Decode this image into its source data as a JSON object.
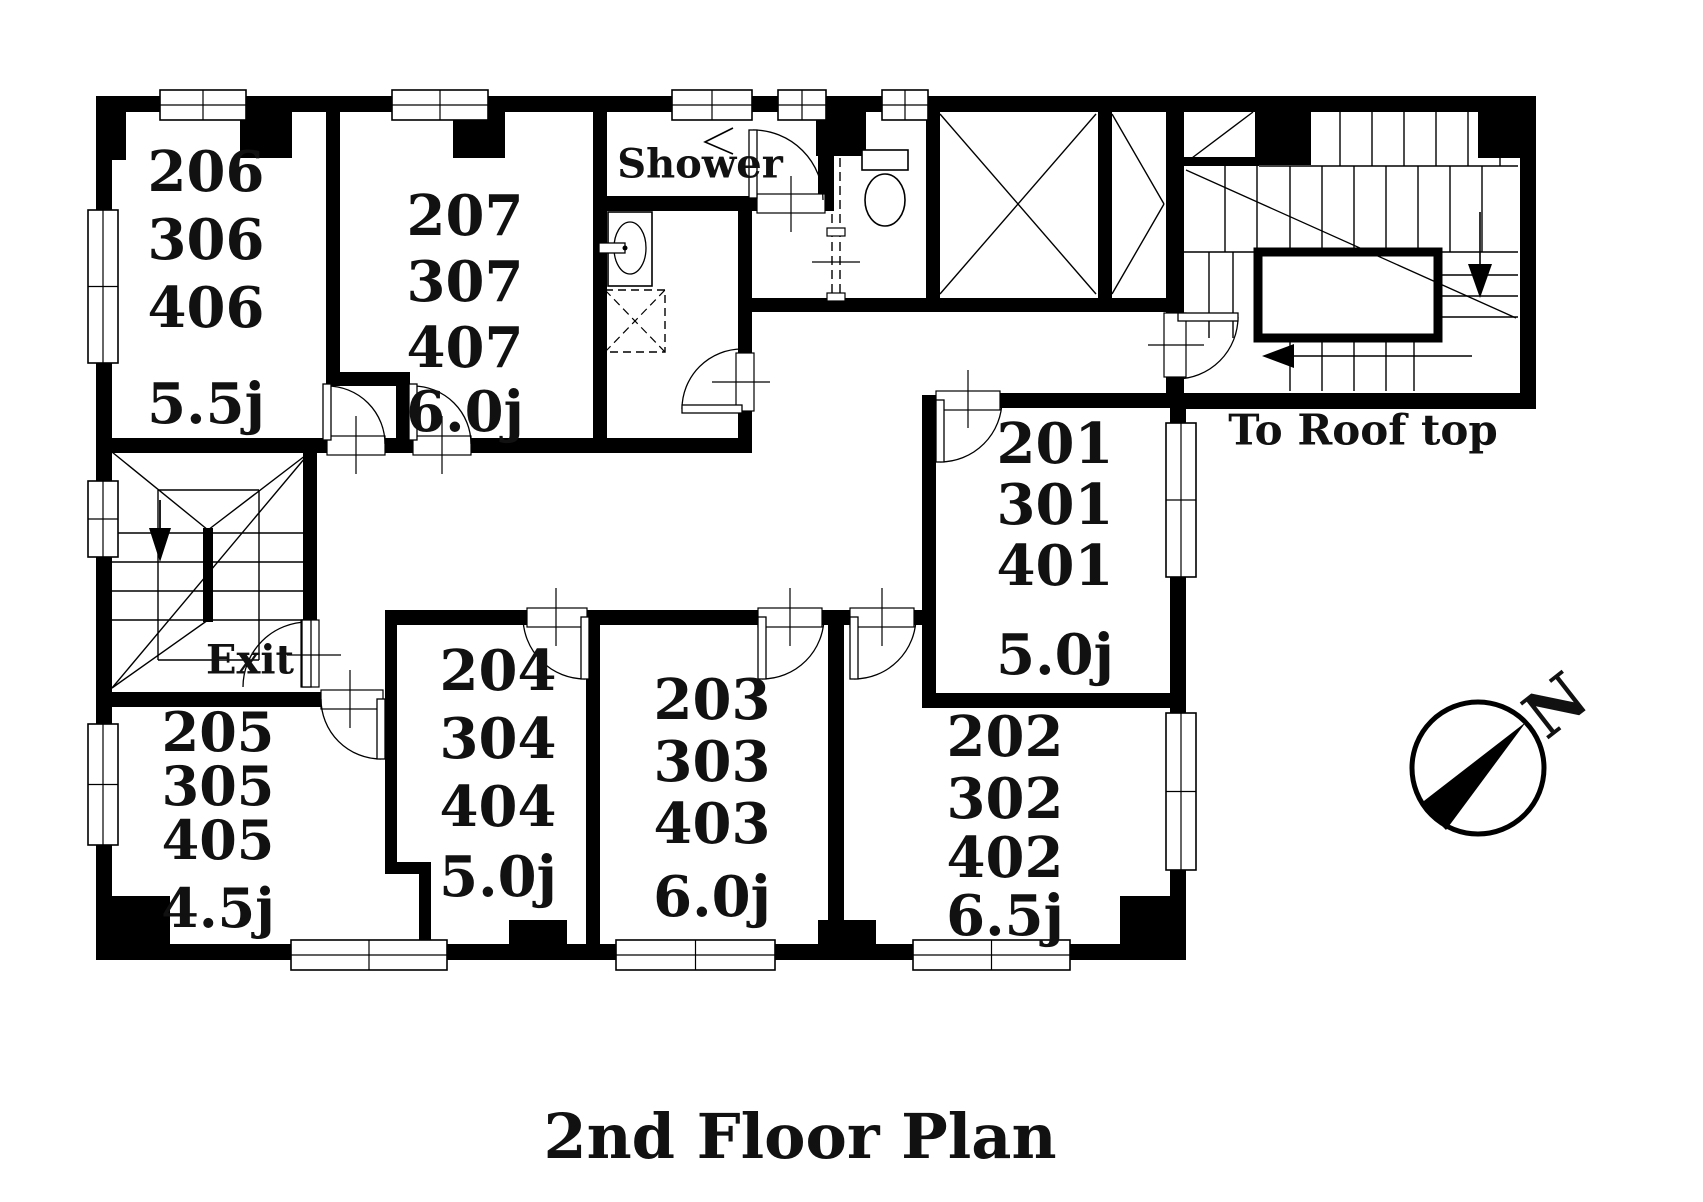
{
  "title": {
    "text": "2nd Floor Plan"
  },
  "compass": {
    "label": "N",
    "cx": 1478,
    "cy": 768,
    "r": 66,
    "needle": "1526,722 1420,804 1446,830",
    "label_x": 1556,
    "label_y": 706,
    "rotate": -38,
    "label_size": 64
  },
  "rooms": [
    {
      "name": "room-206",
      "numbers": [
        "206",
        "306",
        "406"
      ],
      "area": "5.5j",
      "cx": 206,
      "number_ys": [
        172,
        240,
        308
      ],
      "area_y": 404,
      "size": 56
    },
    {
      "name": "room-207",
      "numbers": [
        "207",
        "307",
        "407"
      ],
      "area": "6.0j",
      "cx": 465,
      "number_ys": [
        216,
        282,
        348
      ],
      "area_y": 412,
      "size": 56
    },
    {
      "name": "room-201",
      "numbers": [
        "201",
        "301",
        "401"
      ],
      "area": "5.0j",
      "cx": 1055,
      "number_ys": [
        444,
        505,
        566
      ],
      "area_y": 655,
      "size": 56
    },
    {
      "name": "room-205",
      "numbers": [
        "205",
        "305",
        "405"
      ],
      "area": "4.5j",
      "cx": 218,
      "number_ys": [
        732,
        786,
        840
      ],
      "area_y": 908,
      "size": 54
    },
    {
      "name": "room-204",
      "numbers": [
        "204",
        "304",
        "404"
      ],
      "area": "5.0j",
      "cx": 498,
      "number_ys": [
        671,
        739,
        807
      ],
      "area_y": 877,
      "size": 56
    },
    {
      "name": "room-203",
      "numbers": [
        "203",
        "303",
        "403"
      ],
      "area": "6.0j",
      "cx": 712,
      "number_ys": [
        700,
        762,
        824
      ],
      "area_y": 897,
      "size": 56
    },
    {
      "name": "room-202",
      "numbers": [
        "202",
        "302",
        "402"
      ],
      "area": "6.5j",
      "cx": 1005,
      "number_ys": [
        737,
        799,
        858
      ],
      "area_y": 916,
      "size": 56
    }
  ],
  "labels": [
    {
      "name": "shower-label",
      "text": "Shower",
      "x": 700,
      "y": 164,
      "size": 40
    },
    {
      "name": "exit-label",
      "text": "Exit",
      "x": 250,
      "y": 660,
      "size": 40
    },
    {
      "name": "roof-top-label",
      "text": "To Roof top",
      "x": 1363,
      "y": 430,
      "size": 42
    }
  ],
  "geometry": {
    "walls": [
      [
        96,
        96,
        1440,
        16
      ],
      [
        96,
        96,
        16,
        864
      ],
      [
        96,
        944,
        1090,
        16
      ],
      [
        1170,
        395,
        16,
        565
      ],
      [
        1170,
        393,
        366,
        16
      ],
      [
        1520,
        96,
        16,
        313
      ],
      [
        326,
        110,
        14,
        268
      ],
      [
        326,
        372,
        84,
        14
      ],
      [
        396,
        380,
        14,
        62
      ],
      [
        96,
        438,
        231,
        15
      ],
      [
        385,
        438,
        28,
        15
      ],
      [
        471,
        438,
        136,
        15
      ],
      [
        593,
        438,
        157,
        15
      ],
      [
        593,
        110,
        14,
        343
      ],
      [
        593,
        196,
        166,
        15
      ],
      [
        818,
        150,
        16,
        61
      ],
      [
        738,
        211,
        14,
        146
      ],
      [
        738,
        409,
        14,
        44
      ],
      [
        738,
        298,
        434,
        14
      ],
      [
        926,
        110,
        14,
        196
      ],
      [
        1098,
        110,
        14,
        196
      ],
      [
        1166,
        110,
        18,
        205
      ],
      [
        1166,
        377,
        18,
        18
      ],
      [
        1184,
        157,
        75,
        9
      ],
      [
        303,
        446,
        14,
        174
      ],
      [
        96,
        692,
        228,
        15
      ],
      [
        385,
        610,
        12,
        258
      ],
      [
        385,
        862,
        46,
        12
      ],
      [
        419,
        868,
        12,
        78
      ],
      [
        385,
        610,
        142,
        15
      ],
      [
        591,
        610,
        167,
        15
      ],
      [
        822,
        610,
        28,
        15
      ],
      [
        914,
        610,
        22,
        15
      ],
      [
        586,
        610,
        14,
        336
      ],
      [
        828,
        610,
        16,
        336
      ],
      [
        922,
        395,
        14,
        300
      ],
      [
        1000,
        393,
        172,
        15
      ],
      [
        922,
        693,
        250,
        15
      ]
    ],
    "pillars": [
      [
        96,
        96,
        30,
        64
      ],
      [
        240,
        96,
        52,
        62
      ],
      [
        453,
        96,
        52,
        62
      ],
      [
        816,
        96,
        50,
        60
      ],
      [
        1255,
        96,
        56,
        69
      ],
      [
        1478,
        96,
        58,
        62
      ],
      [
        96,
        896,
        74,
        48
      ],
      [
        509,
        920,
        58,
        24
      ],
      [
        818,
        920,
        58,
        24
      ],
      [
        1120,
        896,
        66,
        48
      ]
    ],
    "windows": [
      {
        "r": [
          160,
          90,
          86,
          30
        ],
        "o": "h"
      },
      {
        "r": [
          392,
          90,
          96,
          30
        ],
        "o": "h"
      },
      {
        "r": [
          672,
          90,
          80,
          30
        ],
        "o": "h"
      },
      {
        "r": [
          778,
          90,
          48,
          30
        ],
        "o": "h"
      },
      {
        "r": [
          882,
          90,
          46,
          30
        ],
        "o": "h"
      },
      {
        "r": [
          88,
          210,
          30,
          153
        ],
        "o": "v"
      },
      {
        "r": [
          88,
          481,
          30,
          76
        ],
        "o": "v"
      },
      {
        "r": [
          88,
          724,
          30,
          121
        ],
        "o": "v"
      },
      {
        "r": [
          1166,
          423,
          30,
          154
        ],
        "o": "v"
      },
      {
        "r": [
          1166,
          713,
          30,
          157
        ],
        "o": "v"
      },
      {
        "r": [
          291,
          940,
          156,
          30
        ],
        "o": "h"
      },
      {
        "r": [
          616,
          940,
          159,
          30
        ],
        "o": "h"
      },
      {
        "r": [
          913,
          940,
          157,
          30
        ],
        "o": "h"
      }
    ],
    "doors": [
      {
        "name": "door-206",
        "op": [
          327,
          436,
          58,
          19
        ],
        "leaf": [
          323,
          384,
          8,
          56
        ],
        "arc": "M327,386 A58,58 0 0 1 385,444",
        "tick": [
          356,
          416,
          356,
          474
        ]
      },
      {
        "name": "door-207",
        "op": [
          413,
          436,
          58,
          19
        ],
        "leaf": [
          409,
          384,
          8,
          56
        ],
        "arc": "M413,386 A58,58 0 0 1 471,444",
        "tick": [
          442,
          416,
          442,
          474
        ]
      },
      {
        "name": "door-shower",
        "op": [
          757,
          194,
          68,
          19
        ],
        "leaf": [
          749,
          130,
          8,
          68
        ],
        "arc": "M753,130 A70,70 0 0 1 823,200",
        "tick": [
          791,
          176,
          791,
          232
        ]
      },
      {
        "name": "door-washroom",
        "op": [
          736,
          353,
          18,
          58
        ],
        "leaf": [
          682,
          405,
          60,
          8
        ],
        "arc": "M682,409 A60,60 0 0 1 742,349",
        "tick": [
          712,
          382,
          770,
          382
        ]
      },
      {
        "name": "door-exit",
        "op": [
          301,
          620,
          18,
          67
        ],
        "leaf": [
          302,
          620,
          9,
          67
        ],
        "arc": "M308,622 A65,65 0 0 0 243,687",
        "tick": [
          287,
          655,
          341,
          655
        ]
      },
      {
        "name": "door-205",
        "op": [
          321,
          690,
          62,
          19
        ],
        "leaf": [
          377,
          699,
          8,
          60
        ],
        "arc": "M381,759 A60,60 0 0 1 321,699",
        "tick": [
          350,
          670,
          350,
          728
        ]
      },
      {
        "name": "door-204",
        "op": [
          527,
          608,
          60,
          19
        ],
        "leaf": [
          581,
          617,
          8,
          62
        ],
        "arc": "M585,679 A62,62 0 0 1 523,617",
        "tick": [
          556,
          588,
          556,
          646
        ]
      },
      {
        "name": "door-203",
        "op": [
          758,
          608,
          64,
          19
        ],
        "leaf": [
          758,
          617,
          8,
          62
        ],
        "arc": "M762,679 A62,62 0 0 0 824,617",
        "tick": [
          790,
          588,
          790,
          646
        ]
      },
      {
        "name": "door-202",
        "op": [
          850,
          608,
          64,
          19
        ],
        "leaf": [
          850,
          617,
          8,
          62
        ],
        "arc": "M854,679 A62,62 0 0 0 916,617",
        "tick": [
          882,
          588,
          882,
          646
        ]
      },
      {
        "name": "door-201",
        "op": [
          936,
          391,
          64,
          19
        ],
        "leaf": [
          936,
          400,
          8,
          62
        ],
        "arc": "M940,462 A62,62 0 0 0 1002,400",
        "tick": [
          968,
          370,
          968,
          428
        ]
      },
      {
        "name": "door-roof-stair",
        "op": [
          1164,
          313,
          22,
          64
        ],
        "leaf": [
          1178,
          313,
          60,
          8
        ],
        "arc": "M1238,317 A62,62 0 0 1 1176,379",
        "tick": [
          1148,
          345,
          1204,
          345
        ]
      }
    ],
    "lines": [
      [
        940,
        114,
        1096,
        294
      ],
      [
        940,
        294,
        1096,
        114
      ],
      [
        1112,
        114,
        1164,
        204
      ],
      [
        1112,
        294,
        1164,
        204
      ],
      [
        1340,
        112,
        1340,
        166
      ],
      [
        1372,
        112,
        1372,
        166
      ],
      [
        1404,
        112,
        1404,
        166
      ],
      [
        1436,
        112,
        1436,
        166
      ],
      [
        1468,
        112,
        1468,
        166
      ],
      [
        1500,
        112,
        1500,
        166
      ],
      [
        1259,
        166,
        1518,
        166
      ],
      [
        1225,
        166,
        1225,
        252
      ],
      [
        1257,
        166,
        1257,
        252
      ],
      [
        1290,
        166,
        1290,
        252
      ],
      [
        1322,
        166,
        1322,
        252
      ],
      [
        1354,
        166,
        1354,
        252
      ],
      [
        1386,
        166,
        1386,
        252
      ],
      [
        1418,
        166,
        1418,
        252
      ],
      [
        1450,
        166,
        1450,
        252
      ],
      [
        1482,
        166,
        1482,
        252
      ],
      [
        1184,
        252,
        1258,
        252
      ],
      [
        1438,
        252,
        1518,
        252
      ],
      [
        1438,
        275,
        1518,
        275
      ],
      [
        1438,
        296,
        1518,
        296
      ],
      [
        1438,
        317,
        1518,
        317
      ],
      [
        1290,
        340,
        1290,
        391
      ],
      [
        1322,
        340,
        1322,
        391
      ],
      [
        1354,
        340,
        1354,
        391
      ],
      [
        1386,
        340,
        1386,
        391
      ],
      [
        1414,
        340,
        1414,
        391
      ],
      [
        1209,
        252,
        1209,
        338
      ],
      [
        1233,
        252,
        1233,
        338
      ],
      [
        1184,
        164,
        1253,
        112
      ],
      [
        158,
        490,
        259,
        490
      ],
      [
        158,
        660,
        259,
        660
      ],
      [
        158,
        490,
        158,
        660
      ],
      [
        259,
        490,
        259,
        660
      ],
      [
        112,
        452,
        208,
        530
      ],
      [
        310,
        452,
        208,
        530
      ],
      [
        310,
        452,
        112,
        688
      ],
      [
        112,
        688,
        208,
        620
      ],
      [
        112,
        533,
        203,
        533
      ],
      [
        112,
        562,
        203,
        562
      ],
      [
        112,
        591,
        203,
        591
      ],
      [
        112,
        620,
        203,
        620
      ],
      [
        212,
        533,
        310,
        533
      ],
      [
        212,
        562,
        310,
        562
      ],
      [
        212,
        591,
        310,
        591
      ],
      [
        212,
        620,
        310,
        620
      ],
      [
        160,
        500,
        160,
        528
      ]
    ],
    "over_lines": [
      [
        1186,
        170,
        1516,
        318
      ]
    ],
    "landing": [
      1258,
      252,
      180,
      86
    ],
    "exit_bar": [
      203,
      528,
      10,
      94
    ],
    "arrows": [
      {
        "name": "exit-down-arrow",
        "stem": [
          160,
          500,
          160,
          528
        ],
        "head": "149,528 171,528 160,562"
      },
      {
        "name": "roof-down-arrow",
        "stem": [
          1480,
          212,
          1480,
          266
        ],
        "head": "1468,264 1492,264 1480,298"
      },
      {
        "name": "roof-left-arrow",
        "stem": [
          1294,
          356,
          1472,
          356
        ],
        "head": "1294,344 1294,368 1262,356"
      }
    ],
    "toilet": {
      "tank": [
        862,
        150,
        46,
        20
      ],
      "bowl": [
        885,
        200,
        20,
        26
      ]
    },
    "sink": {
      "body": [
        608,
        212,
        44,
        74
      ],
      "oval": [
        630,
        248,
        16,
        26
      ],
      "faucet": [
        599,
        243,
        26,
        10
      ]
    },
    "pan": {
      "r": [
        605,
        290,
        60,
        62
      ]
    },
    "shower_head": "733,128 705,142 733,154",
    "slide_door": {
      "lines": [
        [
          832,
          158,
          832,
          300
        ],
        [
          840,
          158,
          840,
          300
        ]
      ],
      "feet": [
        [
          827,
          228,
          18,
          8
        ],
        [
          827,
          293,
          18,
          8
        ]
      ],
      "tick": [
        812,
        262,
        860,
        262
      ]
    }
  }
}
